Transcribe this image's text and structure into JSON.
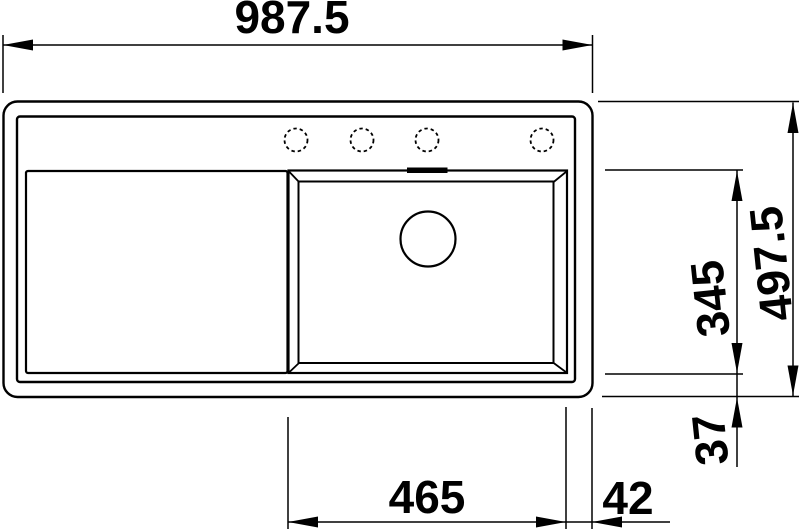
{
  "drawing": {
    "labels": {
      "overall_width": "987.5",
      "overall_depth": "497.5",
      "bowl_depth": "345",
      "bottom_offset": "37",
      "bowl_width": "465",
      "right_offset": "42"
    },
    "colors": {
      "line": "#000000",
      "background": "#ffffff"
    }
  }
}
